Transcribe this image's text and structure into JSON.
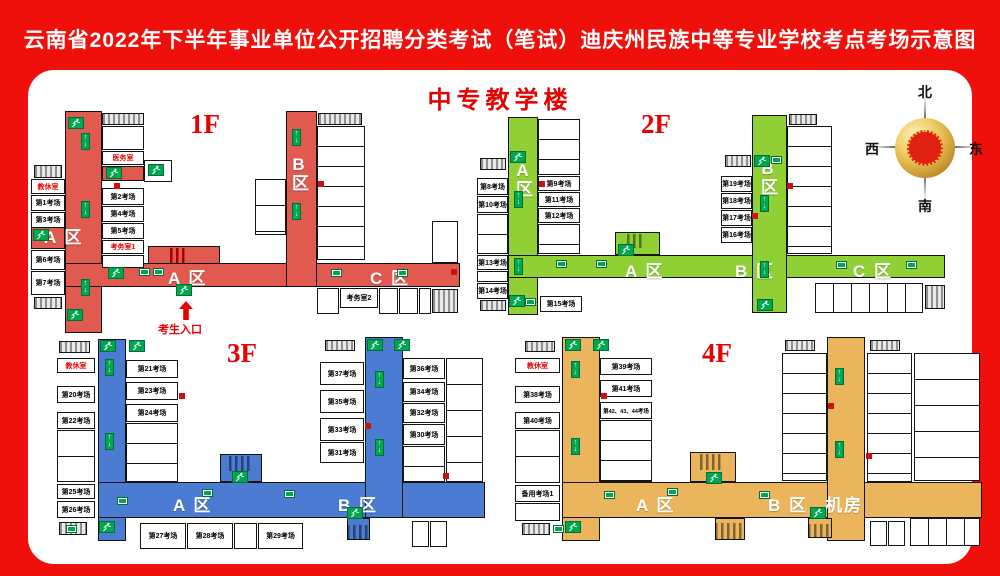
{
  "banner": {
    "title": "云南省2022年下半年事业单位公开招聘分类考试（笔试）迪庆州民族中等专业学校考点考场示意图"
  },
  "panel": {
    "building_title": "中专教学楼"
  },
  "compass": {
    "north": "北",
    "south": "南",
    "east": "东",
    "west": "西"
  },
  "colors": {
    "banner_red": "#EF100C",
    "floor1_red": "#E15A50",
    "floor2_green": "#90D035",
    "floor3_blue": "#4B7CD1",
    "floor4_orange": "#EAB55C",
    "exit_green": "#00A650",
    "label_red": "#E60000"
  },
  "icons": {
    "exit_stair_arrows": "↑↓",
    "entrance_arrow": "▲"
  },
  "floor1": {
    "label": "1F",
    "zone_a_vertical": "A 区",
    "zone_a_horizontal": "A 区",
    "zone_b": "B区",
    "zone_c": "C 区",
    "rooms_left": [
      "教休室",
      "第1考场",
      "第3考场",
      "第6考场",
      "第7考场"
    ],
    "rooms_mid": [
      "医务室",
      "第2考场",
      "第4考场",
      "第5考场",
      "考务室1"
    ],
    "room_kaowu2": "考务室2",
    "entrance_label": "考生入口"
  },
  "floor2": {
    "label": "2F",
    "zone_a_vertical": "A区",
    "zone_a_horizontal": "A 区",
    "zone_b_vertical": "B区",
    "zone_b_horizontal": "B 区",
    "zone_c": "C 区",
    "rooms_left": [
      "第8考场",
      "第10考场",
      "第13考场",
      "第14考场"
    ],
    "rooms_mid": [
      "第9考场",
      "第11考场",
      "第12考场"
    ],
    "room_15": "第15考场",
    "rooms_bwing": [
      "第19考场",
      "第18考场",
      "第17考场",
      "第16考场"
    ]
  },
  "floor3": {
    "label": "3F",
    "zone_a": "A 区",
    "zone_b": "B 区",
    "rooms_left": [
      "教休室",
      "第20考场",
      "第22考场",
      "第25考场",
      "第26考场"
    ],
    "rooms_mid": [
      "第21考场",
      "第23考场",
      "第24考场"
    ],
    "rooms_bottom": [
      "第27考场",
      "第28考场",
      "第29考场"
    ],
    "rooms_bwing_left": [
      "第37考场",
      "第35考场",
      "第33考场",
      "第31考场"
    ],
    "rooms_bwing_right": [
      "第36考场",
      "第34考场",
      "第32考场",
      "第30考场"
    ]
  },
  "floor4": {
    "label": "4F",
    "zone_a": "A 区",
    "zone_b": "B 区",
    "zone_jifang": "机房",
    "rooms_left": [
      "教休室",
      "第38考场",
      "第40考场",
      "备用考场1"
    ],
    "rooms_mid": [
      "第39考场",
      "第41考场",
      "第42、43、44考场"
    ]
  }
}
